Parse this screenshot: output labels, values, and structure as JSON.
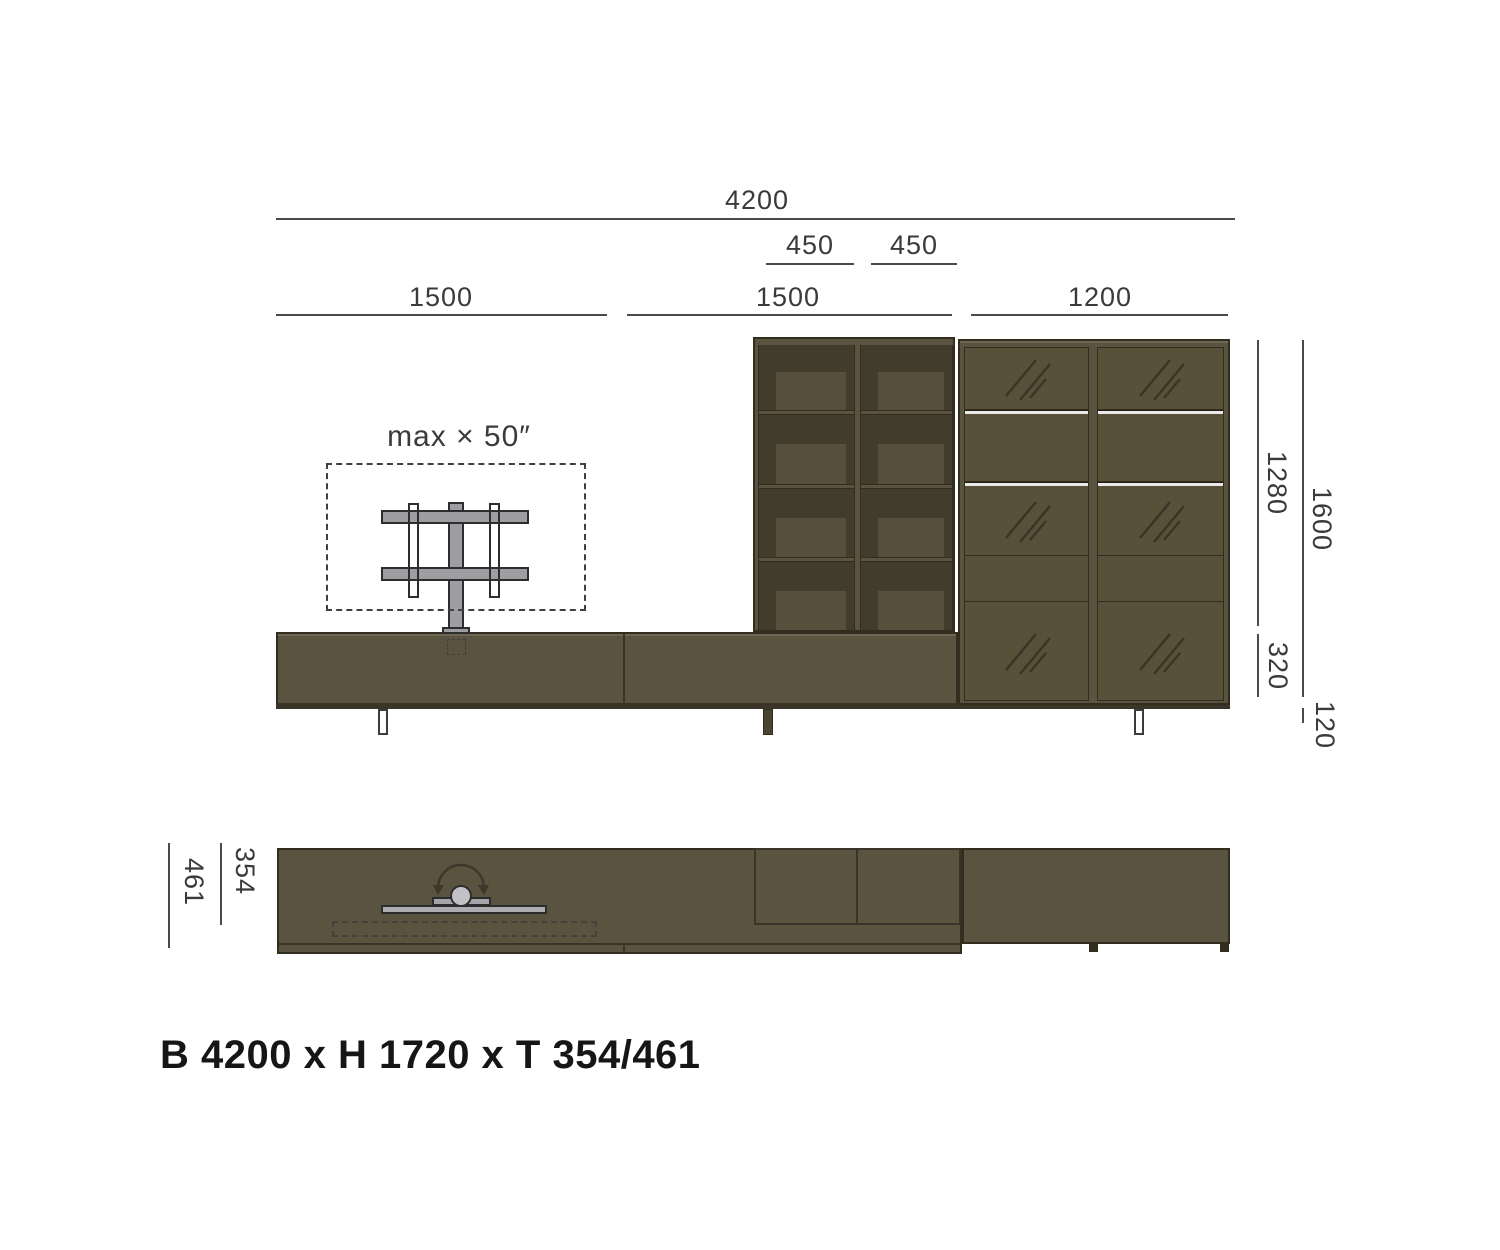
{
  "caption": "B 4200 x H 1720 x T 354/461",
  "dims": {
    "overall_width": "4200",
    "shelf_col_left": "450",
    "shelf_col_right": "450",
    "segment_left": "1500",
    "segment_middle": "1500",
    "segment_right": "1200",
    "upper_section_height": "1280",
    "unit_height": "1600",
    "bench_height": "320",
    "leg_height": "120",
    "depth_body": "354",
    "depth_max": "461"
  },
  "notes": {
    "tv_max_size": "max × 50″"
  },
  "colors": {
    "body": "#5A5340",
    "outline": "#332D20",
    "interior": "#423C2C",
    "interior_panel": "#564F3B",
    "silver_shelf": "#E9E9E5",
    "metal_gray": "#9E9DA2",
    "dimension_text": "#3A3A3A",
    "caption_text": "#161616",
    "background": "#FFFFFF"
  }
}
